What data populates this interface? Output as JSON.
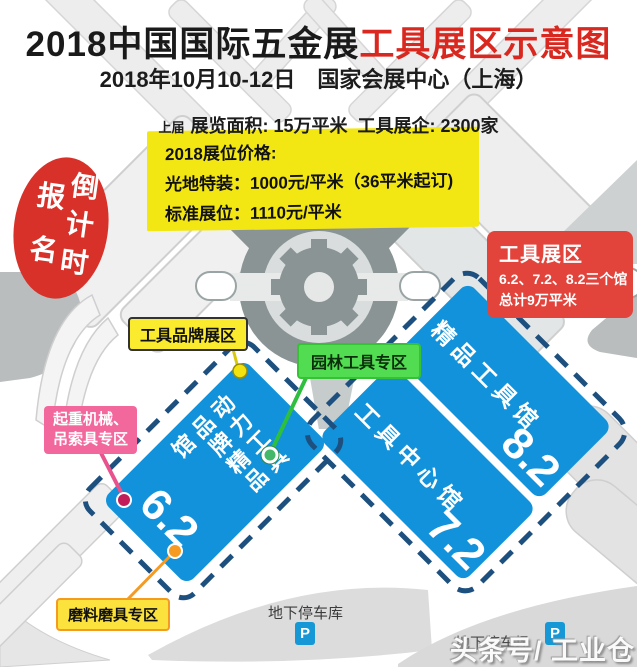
{
  "header": {
    "title_black": "2018中国国际五金展",
    "title_red": "工具展区示意图",
    "subtitle": "2018年10月10-12日　国家会展中心（上海）",
    "prev_edition_label": "上届",
    "prev_edition_stats": "展览面积: 15万平米  工具展企: 2300家"
  },
  "price_box": {
    "title": "2018展位价格:",
    "raw_space_line": "光地特装：1000元/平米（36平米起订)",
    "standard_booth_line": "标准展位：1110元/平米"
  },
  "countdown_badge": {
    "left_column": "报名",
    "right_column": "倒计时"
  },
  "zone_box": {
    "title": "工具展区",
    "halls_line": "6.2、7.2、8.2三个馆",
    "area_line": "总计9万平米"
  },
  "callouts": {
    "tool_brand_zone": "工具品牌展区",
    "garden_tool_zone": "园林工具专区",
    "lifting_zone_line1": "起重机械、",
    "lifting_zone_line2": "吊索具专区",
    "abrasives_zone": "磨料磨具专区"
  },
  "halls": [
    {
      "number": "6.2",
      "name": "动力工具品牌精品馆"
    },
    {
      "number": "7.2",
      "name": "工具中心馆"
    },
    {
      "number": "8.2",
      "name": "精品工具馆"
    }
  ],
  "parking": {
    "garage_label": "地下停车库",
    "lot_label": "地下停车场",
    "p_symbol": "P"
  },
  "watermark": "头条号/ 工业仓",
  "colors": {
    "hall_blue": "#1192DB",
    "dashed_border": "#1D507E",
    "price_yellow": "#F3E713",
    "zone_red": "#E2433B",
    "badge_red": "#D7312A",
    "title_red": "#D9281F",
    "garden_green": "#52DC52",
    "lifting_pink": "#F2679C",
    "abrasive_orange": "#F59B22",
    "parking_blue": "#1798D6"
  }
}
